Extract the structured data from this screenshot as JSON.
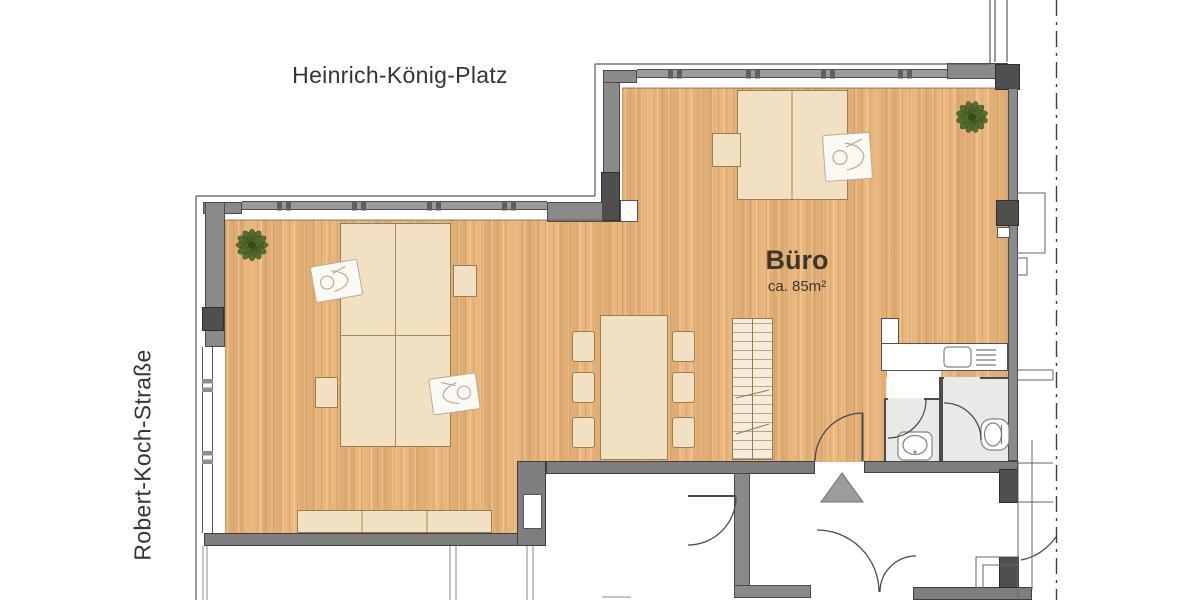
{
  "plan": {
    "street_top": "Heinrich-König-Platz",
    "street_left": "Robert-Koch-Straße",
    "room": {
      "name": "Büro",
      "area": "ca. 85m²"
    }
  },
  "colors": {
    "wood": "#e9b77d",
    "furniture": "#f2e0c2",
    "furniture_border": "#9b7d52",
    "wall": "#8a8a8a",
    "wall_dark": "#4f4f4f",
    "bottom_wall": "#7e7e7e",
    "bath_floor": "#e9e9e9",
    "glass_frame": "#9a9a9a",
    "shelf_fill": "#f6ecd9",
    "shelf_line": "#8d7c5d",
    "plant": "#4d682c",
    "person_fill": "#fbf9f4",
    "person_stroke": "#b9ac93",
    "triangle": "#9c9c9c",
    "text": "#3a332d"
  }
}
